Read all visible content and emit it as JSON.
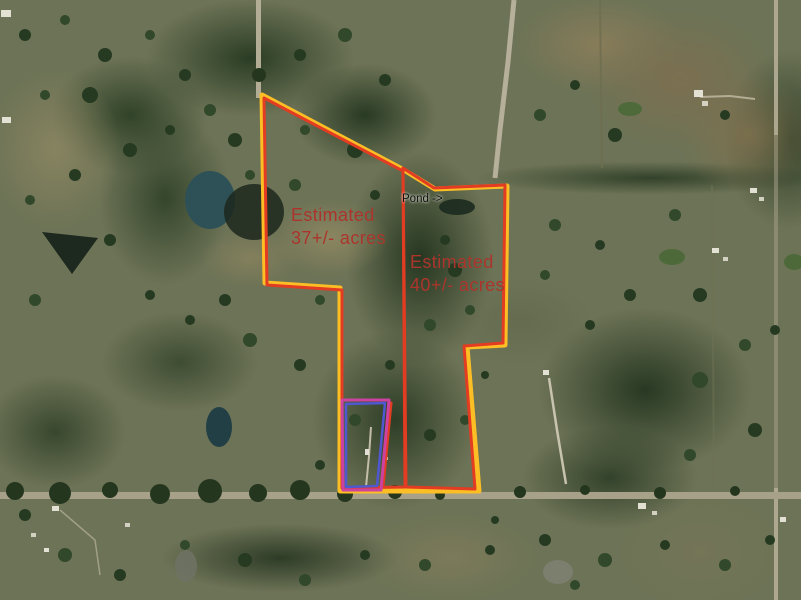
{
  "map": {
    "description": "Aerial satellite view of rural acreage with surveyed parcel boundary overlays",
    "colors": {
      "combined_boundary": "#fcbe25",
      "parcel_outline": "#e23c22",
      "excluded_parcel_outer": "#cc42a0",
      "excluded_parcel_inner": "#4f58d0",
      "acreage_text": "#ab352c",
      "pond_text": "#101010"
    },
    "labels": {
      "parcel_37": {
        "line1": "Estimated",
        "line2": "37+/- acres"
      },
      "parcel_40": {
        "line1": "Estimated",
        "line2": "40+/- acres"
      },
      "pond": {
        "text": "Pond ->"
      }
    },
    "overlays": {
      "combined_boundary": {
        "name": "combined-property-boundary",
        "stroke": "#fcbe25",
        "stroke_width": 5,
        "closed": true,
        "points": "262,95 404,170 435,189 507,186 505,345 467,347 479,491 340,491 340,288 265,283"
      },
      "parcel_37_boundary": {
        "name": "parcel-37-boundary",
        "stroke": "#e23c22",
        "stroke_width": 3,
        "closed": true,
        "points": "267,285 264,98 403,171 405,487 342,488 342,290"
      },
      "parcel_37_exclusion_edge": {
        "name": "parcel-37-exclusion-edge",
        "stroke": "#e23c22",
        "stroke_width": 3,
        "closed": false,
        "points": "391,403 383,487"
      },
      "parcel_40_boundary": {
        "name": "parcel-40-boundary",
        "stroke": "#e23c22",
        "stroke_width": 3,
        "closed": true,
        "points": "403,168 434,188 505,185 503,343 464,346 475,489 406,487"
      },
      "excluded_parcel_outer": {
        "name": "excluded-homesite-outer-boundary",
        "stroke": "#cc42a0",
        "stroke_width": 3,
        "closed": true,
        "points": "342,400 389,400 381,490 343,490"
      },
      "excluded_parcel_inner": {
        "name": "excluded-homesite-inner-boundary",
        "stroke": "#4f58d0",
        "stroke_width": 2.5,
        "closed": true,
        "points": "346,404 385,403 377,486 346,487"
      }
    }
  }
}
